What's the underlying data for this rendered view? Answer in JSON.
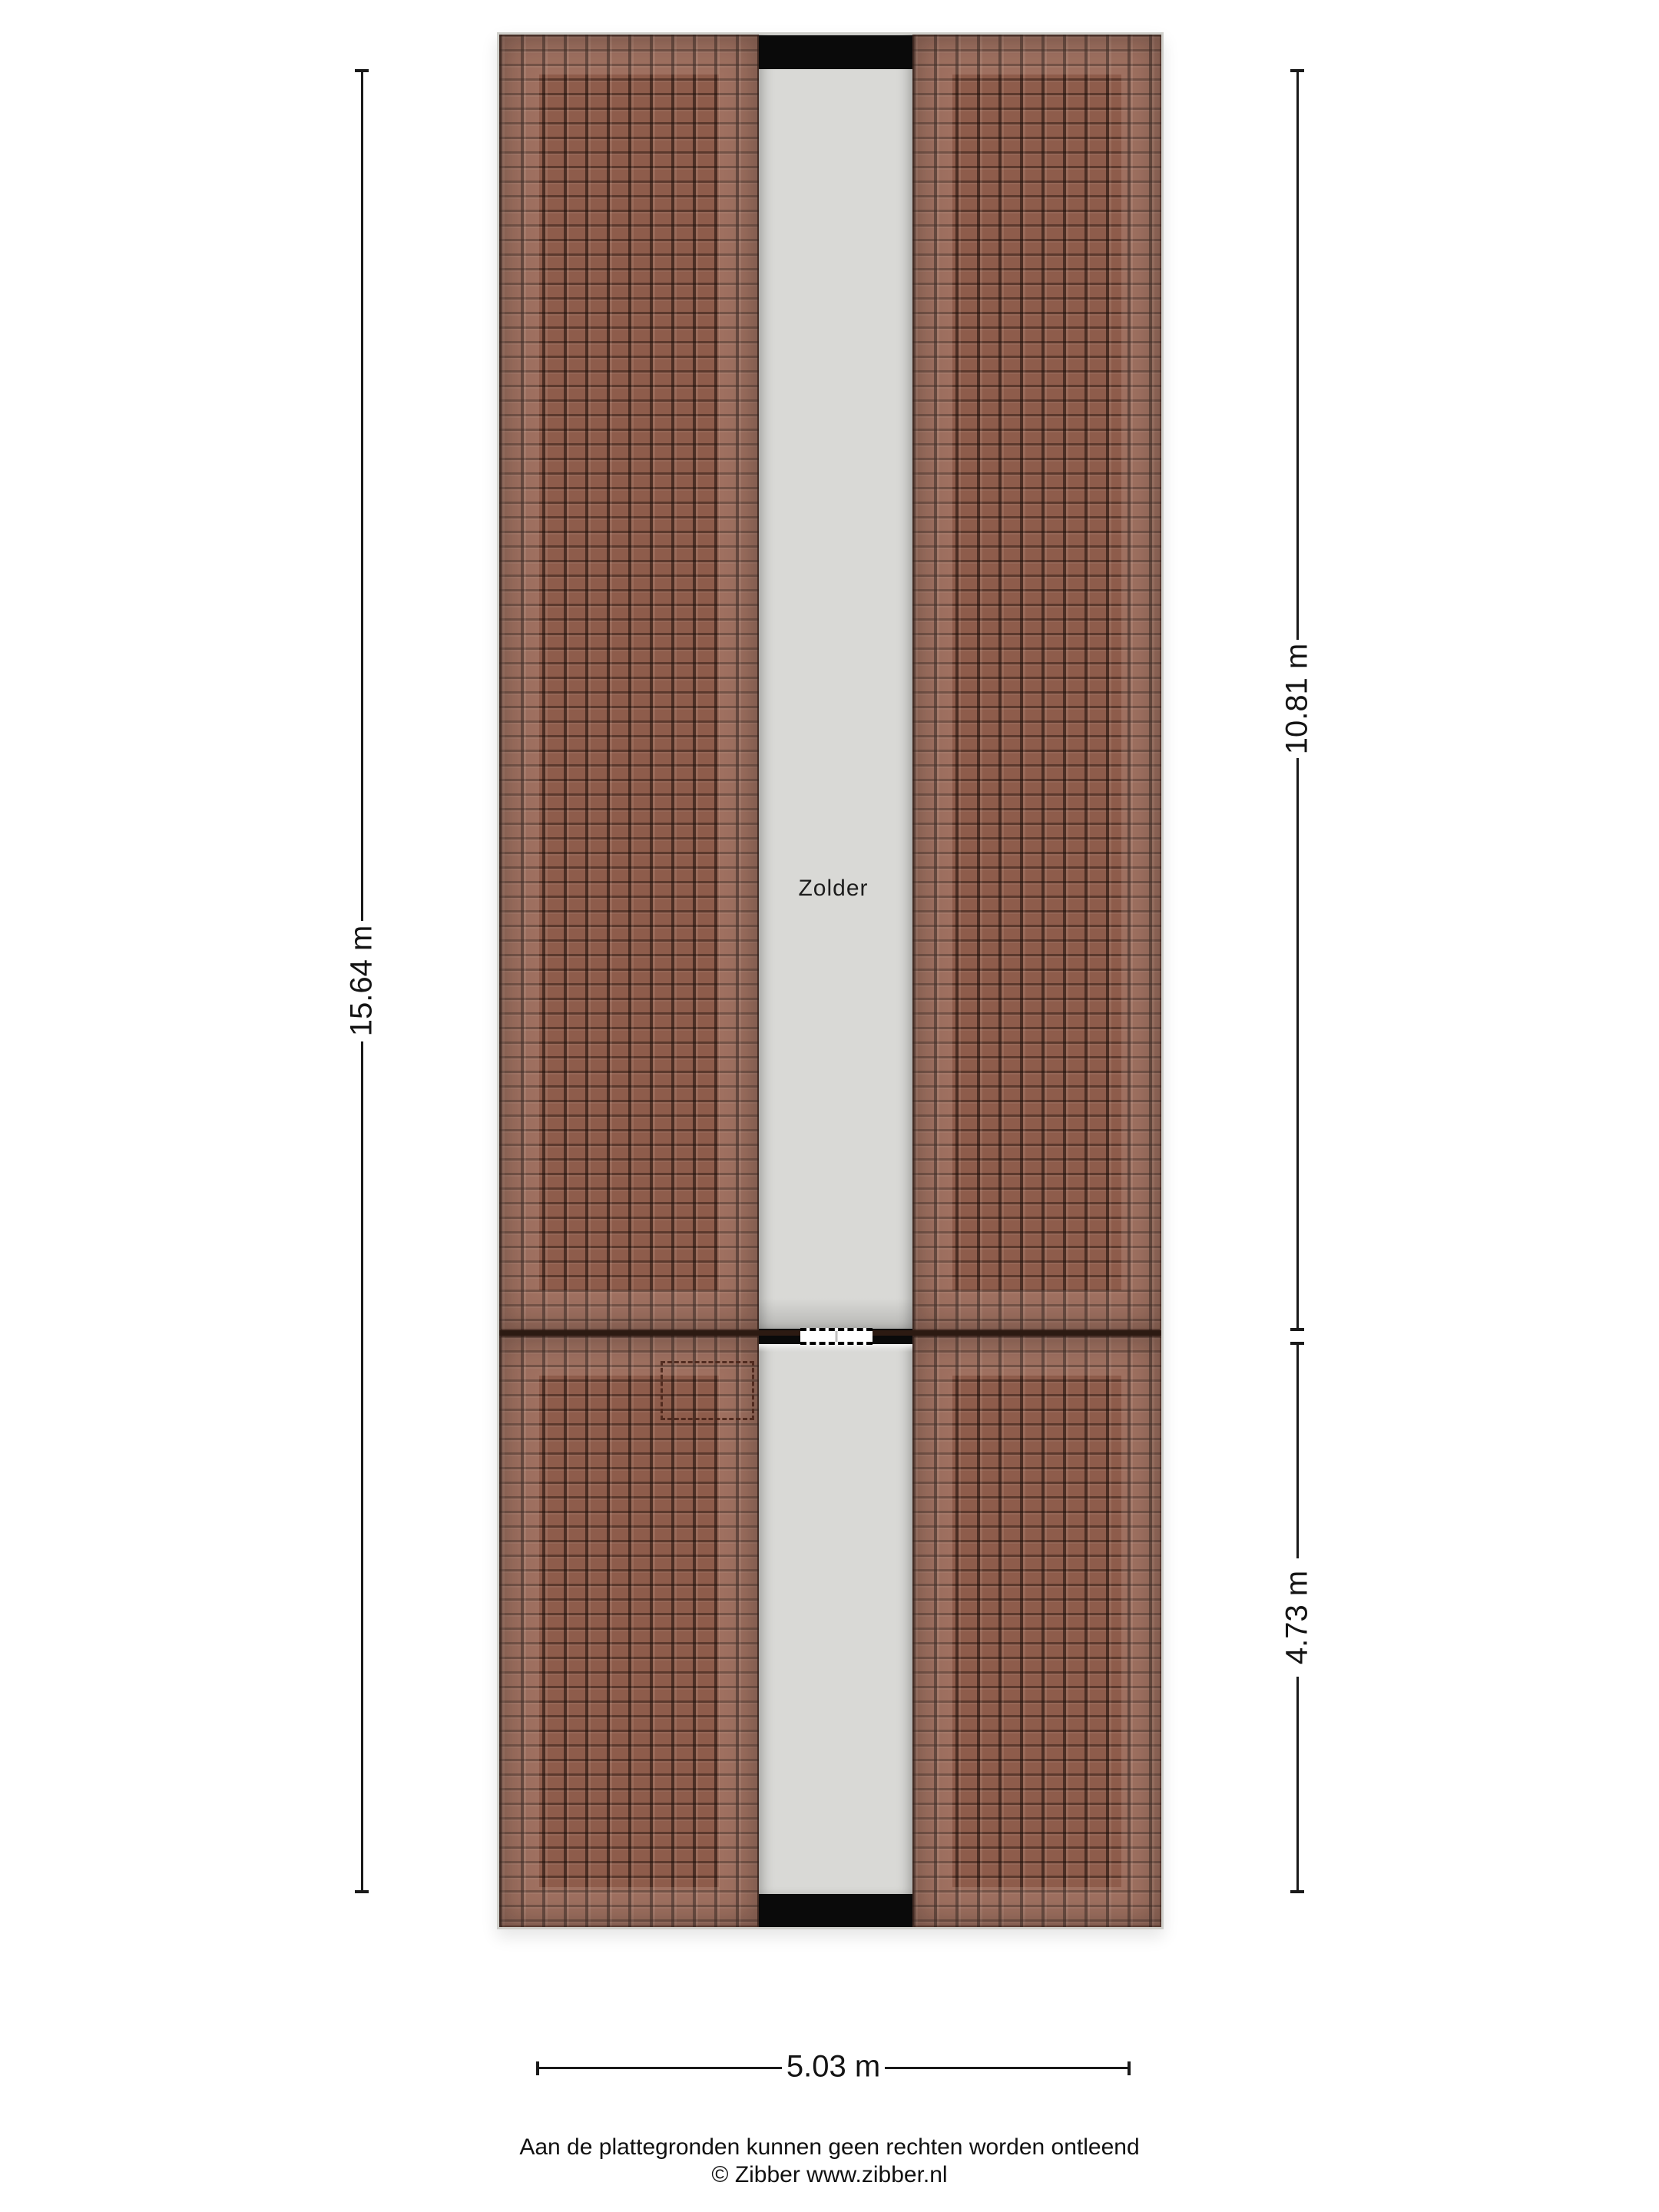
{
  "floorplan": {
    "room_label": "Zolder",
    "dimensions": {
      "overall_height": "15.64 m",
      "upper_section_height": "10.81 m",
      "lower_section_height": "4.73 m",
      "width": "5.03 m"
    },
    "colors": {
      "roof-tile": "#8e5c4b",
      "roof-line": "#2c1a12",
      "floor-gray": "#d9d9d6",
      "band-black": "#0a0a0a"
    }
  },
  "footer": {
    "disclaimer": "Aan de plattegronden kunnen geen rechten worden ontleend",
    "credit": "© Zibber www.zibber.nl"
  }
}
